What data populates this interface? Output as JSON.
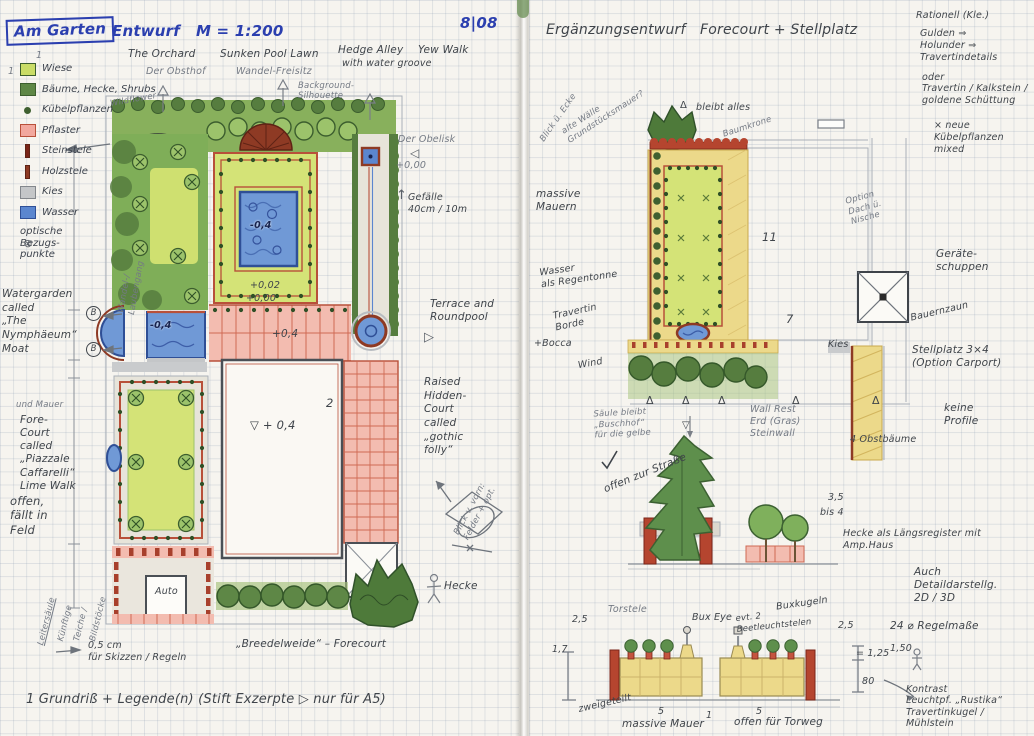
{
  "colors": {
    "ink": "#2b3faf",
    "pencil": "#747a84",
    "pen": "#3f444a",
    "lawn": "#d4e377",
    "hedge": "#567d3f",
    "water": "#7099d6",
    "paving_pink": "#f3bcb0",
    "stone_gold": "#ecd98a",
    "wall_red": "#b5452f",
    "gravel": "#c9cbcd"
  },
  "icons": {
    "opt_marker": "⊗",
    "up_arrow": "↑",
    "left_arrow": "◁",
    "forward_arrow": "▷",
    "delta": "Δ",
    "nabla": "▽",
    "check": "✓"
  },
  "left_page": {
    "header": {
      "project": "Am Garten",
      "doc_type": "Entwurf",
      "scale": "M = 1:200",
      "date": "8|08"
    },
    "legend": {
      "index": "1",
      "items": [
        {
          "label": "Wiese",
          "color": "#c9dc66"
        },
        {
          "label": "Bäume, Hecke, Shrubs",
          "color": "#5e8746"
        },
        {
          "label": "Kübelpflanzen",
          "color": "#3f6030"
        },
        {
          "label": "Pflaster",
          "color": "#f2a89e"
        },
        {
          "label": "Steinstele",
          "color": "#7a2518"
        },
        {
          "label": "Holzstele",
          "color": "#8e3a24"
        },
        {
          "label": "Kies",
          "color": "#c4c6c8"
        },
        {
          "label": "Wasser",
          "color": "#5b86cf"
        },
        {
          "label": "optische\nBezugs-\npunkte",
          "color": ""
        }
      ]
    },
    "areas": {
      "orchard_en": "The Orchard",
      "orchard_de": "Der Obsthof",
      "pool_lawn_en": "Sunken Pool Lawn",
      "pool_lawn_de": "Wandel-Freisitz",
      "hedge_alley": "Hedge Alley",
      "yew_walk": "Yew Walk",
      "water_groove": "with water groove",
      "background": "Background-\nSilhouette",
      "wildflower": "Wildflower",
      "obelisk": "Der Obelisk",
      "datum": "+0,00",
      "gefaelle": "Gefälle\n40cm / 10m",
      "terrace": "Terrace and\nRoundpool",
      "hidden_court": "Raised\nHidden-\nCourt\ncalled\n„gothic\nfolly“",
      "view_note": "Blick v. vorn:\nFelder + opt.",
      "hecke": "Hecke",
      "watergarden": "Watergarden\ncalled\n„The\nNymphäeum“\nMoat",
      "mauer_note": "und Mauer",
      "forecourt": "Fore-\nCourt\ncalled\n„Piazzale\nCaffarelli“\nLime Walk",
      "offen": "offen,\nfällt in\nFeld",
      "wandel": "Wandel-/\nLaubengang",
      "vertical_1": "Leitersäule",
      "vertical_2": "Künftige",
      "vertical_3": "Teiche /",
      "vertical_4": "Bildstöcke",
      "marker_b": "B"
    },
    "values": {
      "pool": "-0,4",
      "lawn_upper": "+0,02",
      "lawn_zero": "+0,00",
      "terrace": "+0,4",
      "court": "▽ + 0,4",
      "moat": "-0,4",
      "section": "2",
      "auto": "Auto"
    },
    "footer": {
      "scale_note": "0,5 cm\nfür Skizzen / Regeln",
      "breede": "„Breedelweide“ – Forecourt",
      "caption": "1 Grundriß + Legende(n) (Stift Exzerpte ▷ nur für A5)"
    }
  },
  "right_page": {
    "header": {
      "title": "Ergänzungsentwurf",
      "subtitle": "Forecourt + Stellplatz"
    },
    "corner": {
      "head": "Rationell (Kle.)",
      "lines": "Gulden ⇒\nHolunder ⇒\nTravertindetails"
    },
    "notes": {
      "diag_view": "Blick ü. Ecke",
      "diag_wall": "alte Wälle\nGrundstücksmauer?",
      "bleibt": "bleibt alles",
      "baumkrone": "Baumkrone",
      "material": "oder\nTravertin / Kalkstein /\ngoldene Schüttung",
      "kuebel": "× neue\nKübelpflanzen\nmixed",
      "massive": "massive\nMauern",
      "wasser": "Wasser\nals Regentonne",
      "travertin": "Travertin\nBorde",
      "bocca": "+Bocca",
      "wind": "Wind",
      "option_dach": "Option\nDach ü.\nNische",
      "geraete": "Geräte-\nschuppen",
      "bauernzaun": "Bauernzaun",
      "stellplatz": "Stellplatz 3×4\n(Option Carport)",
      "keine_profile": "keine\nProfile",
      "kies": "Kies",
      "wallrest": "Wall Rest\nErd (Gras)\nSteinwall",
      "obstbaeume": "4 Obstbäume",
      "saeule": "Säule bleibt\n„Buschhof“\nfür die gelbe",
      "offen_strasse": "offen zur Straße",
      "harmony": "Hecke als Längsregister mit Amp.Haus",
      "detail": "Auch\nDetaildarstellg.\n2D / 3D",
      "regelmass": "24 ⌀ Regelmaße"
    },
    "values": {
      "n11": "11",
      "n7": "7",
      "h35": "3,5",
      "h4": "bis 4",
      "h125": "= 1,25",
      "h150": "1,50",
      "h80": "80"
    },
    "lighting": {
      "kontrast": "Kontrast\nLeuchtpf. „Rustika“\nTravertinkugel /\nMühlstein"
    },
    "elevation": {
      "torstele": "Torstele",
      "buxeye": "Bux Eye",
      "leucht": "evt. 2\nBeetleuchtstelen",
      "buxkugeln": "Buxkugeln",
      "d_left": "2,5",
      "d_17": "1,7",
      "d_right": "2,5",
      "zweigeteilt": "zweigeteilt",
      "seg_a": "5",
      "seg_gap": "1",
      "seg_b": "5",
      "mauer": "massive Mauer",
      "offen": "offen für Torweg"
    }
  }
}
